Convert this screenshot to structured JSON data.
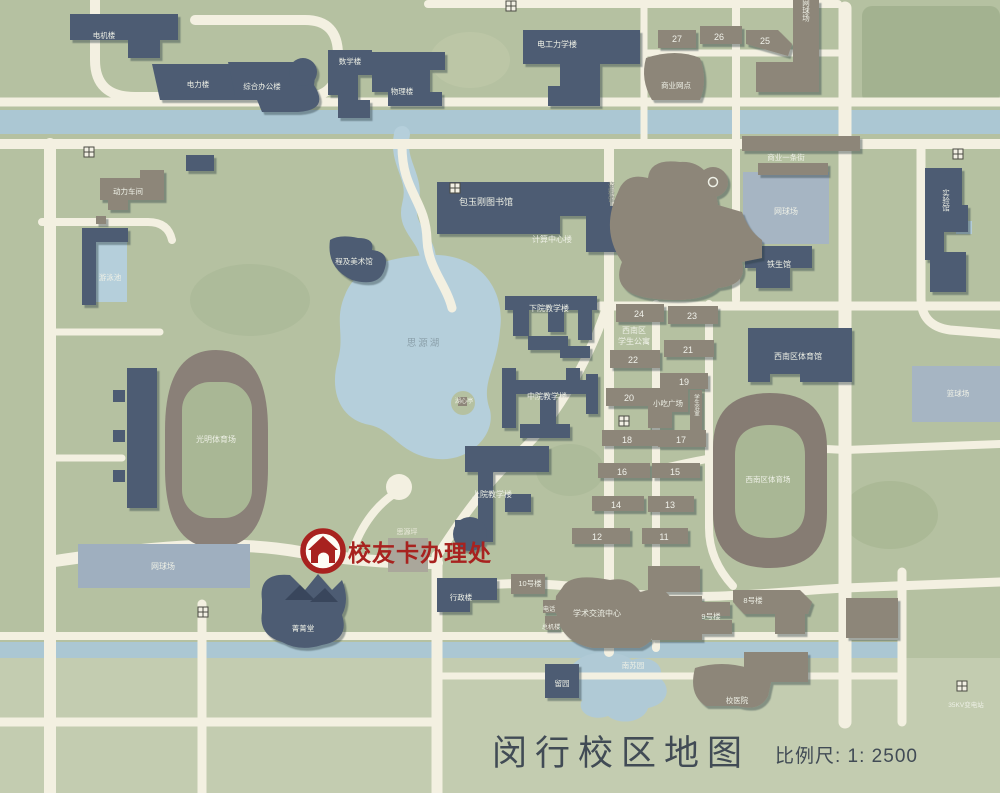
{
  "title": {
    "text": "闵行校区地图",
    "scale": "比例尺: 1: 2500"
  },
  "marker": {
    "label": "校友卡办理处"
  },
  "colors": {
    "background_green": "#b5c1a1",
    "light_green_band": "#c3ccb0",
    "road": "#f3f0e1",
    "water": "#abc7d3",
    "building_navy": "#4d5c73",
    "building_gray": "#8d8679",
    "court_blue": "#a6b5c3",
    "track_gray": "#867c73",
    "marker_red": "#a8221f",
    "title_text": "#414b55"
  },
  "map": {
    "labels": {
      "dianji": "电机楼",
      "dianli": "电力楼",
      "zongheban": "综合办公楼",
      "shuxue": "数学楼",
      "wuli": "物理楼",
      "diangonglixue": "电工力学楼",
      "shangyewangdian": "商业网点",
      "n27": "27",
      "n26": "26",
      "n25": "25",
      "wangqiu_ne": "网球场",
      "shangyejie": "商业一条街",
      "wangqiu_e": "网球场",
      "tiesheng": "铁生馆",
      "shiyanguan": "实验馆",
      "dongli": "动力车间",
      "youyongchi": "游泳池",
      "baotushuguan": "包玉刚图书馆",
      "jisuanzhongxin": "计算中心楼",
      "chengji": "程及美术馆",
      "ziliaoguan": "资料馆",
      "siyuanhu": "思源湖",
      "huxinting": "湖心亭",
      "xiayuan": "下院教学楼",
      "zhongyuan": "中院教学楼",
      "shangyuan": "上院教学楼",
      "siyuanping": "思源坪",
      "guangming": "光明体育场",
      "wangqiu_w": "网球场",
      "jingjingtang": "菁菁堂",
      "xingzheng": "行政楼",
      "n10": "10号楼",
      "xinanqu_line1": "西南区",
      "xinanqu_line2": "学生公寓",
      "n24": "24",
      "n23": "23",
      "n22": "22",
      "n21": "21",
      "n20": "20",
      "n19": "19",
      "n18": "18",
      "n17": "17",
      "n16": "16",
      "n15": "15",
      "n14": "14",
      "n13": "13",
      "n12": "12",
      "n11": "11",
      "xiaochi": "小吃广场",
      "yushi": "学生浴室",
      "xinan_guan": "西南区体育馆",
      "xinan_chang": "西南区体育场",
      "lanqiu": "篮球场",
      "xueshu": "学术交流中心",
      "dianhua_line1": "电话",
      "dianhua_line2": "总机楼",
      "n9": "9号楼",
      "n8": "8号楼",
      "nansuyuan": "南苏园",
      "liuyuan": "留园",
      "xiaoyiyuan": "校医院",
      "bianzhan": "35KV变电站"
    }
  }
}
